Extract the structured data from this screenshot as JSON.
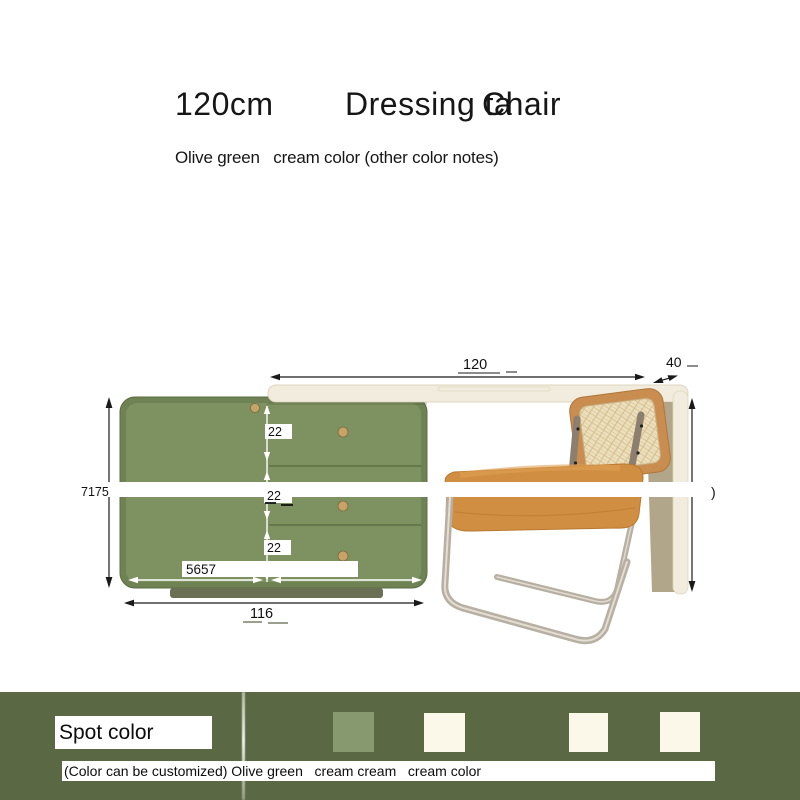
{
  "title": {
    "size": "120cm",
    "name": "Dressing ta",
    "name_cut": "Chair"
  },
  "subtitle": "Olive green   cream color (other color notes)",
  "diagram": {
    "dims": {
      "top_width": "120",
      "depth": "40",
      "left_height": "7175",
      "drawer_1": "22",
      "drawer_2": "22",
      "drawer_3": "22",
      "split_width": "5657",
      "bottom_width": "116",
      "truncated_char": ")"
    },
    "colors": {
      "cabinet_green": "#7e9160",
      "cabinet_rim": "#6e8254",
      "table_cream": "#f1ecdd",
      "leg_khaki": "#b1a689",
      "chair_wood": "#c98e4f",
      "cane": "#ecdfbd",
      "seat_leather": "#d08e42",
      "chrome": "#b7afa2"
    }
  },
  "spot": {
    "label": "Spot color",
    "note": "(Color can be customized) Olive green   cream cream   cream color",
    "band_color": "#5a6944",
    "swatches": [
      {
        "name": "olive green",
        "color": "#87996f"
      },
      {
        "name": "cream",
        "color": "#fbf8ea"
      },
      {
        "name": "cream",
        "color": "#fbf8ea"
      },
      {
        "name": "cream",
        "color": "#fbf8ea"
      }
    ]
  }
}
